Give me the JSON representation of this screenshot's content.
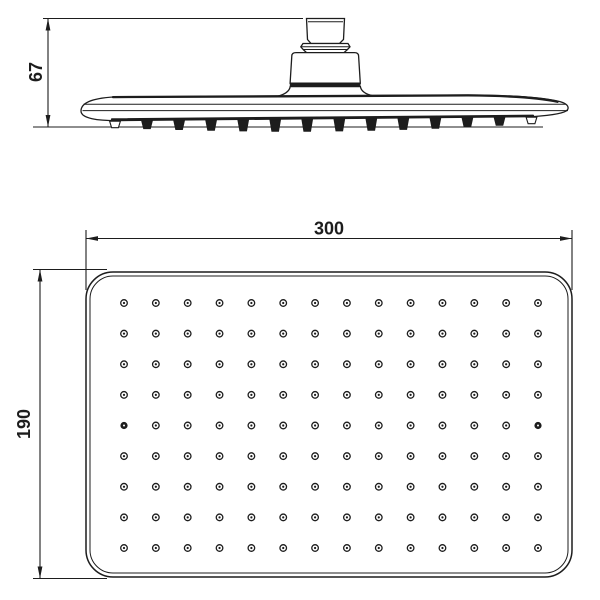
{
  "drawing": {
    "background_color": "#ffffff",
    "line_color": "#1d1d1d",
    "side_view": {
      "height_dimension_label": "67",
      "nozzle_tab_count": 14
    },
    "plan_view": {
      "width_dimension_label": "300",
      "height_dimension_label": "190",
      "nozzle_grid": {
        "rows": 9,
        "columns": 14,
        "total_nozzles": 126,
        "accent_row": 5,
        "accent_columns": [
          1,
          14
        ]
      }
    }
  }
}
